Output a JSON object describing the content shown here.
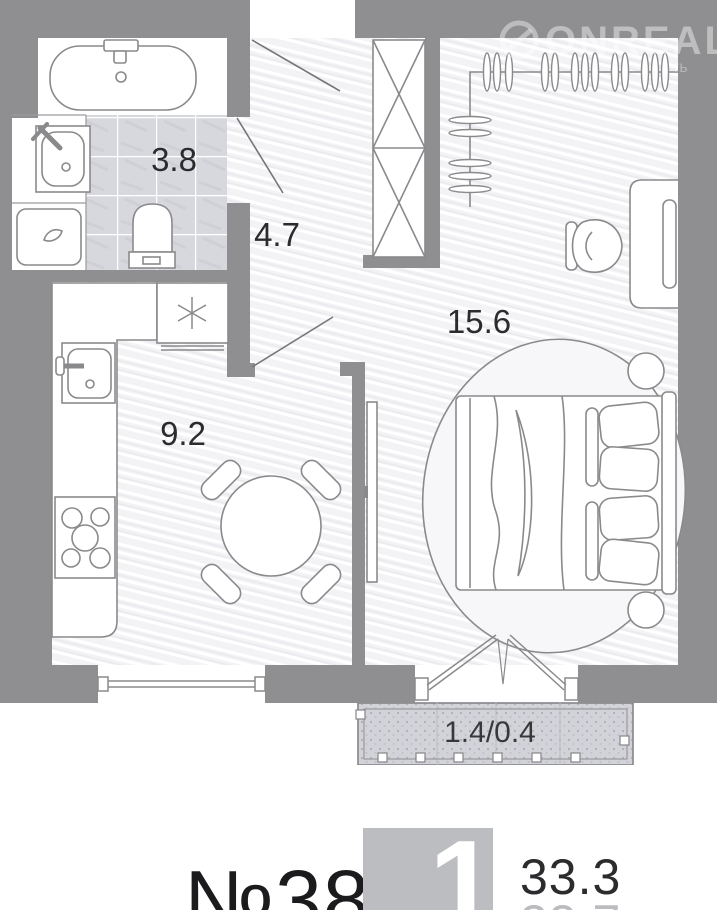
{
  "watermark": {
    "brand": "ONREALT",
    "fragment": "ть"
  },
  "plan": {
    "rooms": {
      "bathroom": {
        "area": "3.8"
      },
      "hallway": {
        "area": "4.7"
      },
      "living_room": {
        "area": "15.6"
      },
      "kitchen": {
        "area": "9.2"
      },
      "balcony": {
        "area": "1.4/0.4"
      }
    }
  },
  "info": {
    "unit_number": "№38",
    "room_count": "1",
    "area_total": "33.3",
    "area_secondary": "33.7"
  },
  "colors": {
    "wall": "#8f8f91",
    "badge": "#bcbdc1",
    "label_text": "#2b2b2d"
  }
}
